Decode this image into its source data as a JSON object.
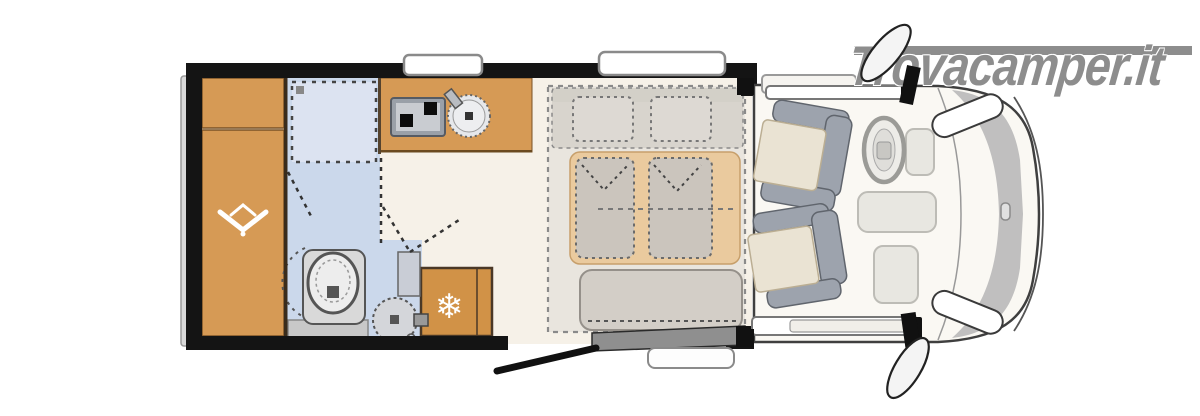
{
  "watermark": {
    "text": "Trovacamper.it",
    "color": "#8d8d8d"
  },
  "icons": {
    "snowflake": "❄",
    "hanger": "wardrobe-hanger-symbol"
  },
  "floorplan": {
    "type": "motorhome-top-view-layout",
    "vehicle_front": "right",
    "areas": [
      {
        "name": "rear-cabinet",
        "kind": "overhead cabinet",
        "color": "#d69a55"
      },
      {
        "name": "wardrobe",
        "kind": "wardrobe with hanger symbol",
        "color": "#d69a55"
      },
      {
        "name": "shower",
        "kind": "shower cubicle",
        "color": "#dce3f1"
      },
      {
        "name": "bathroom",
        "kind": "washroom with toilet and basin",
        "color": "#cbd8eb"
      },
      {
        "name": "kitchen",
        "kind": "kitchen block with 2-burner stove and round sink",
        "color": "#d69a55"
      },
      {
        "name": "refrigerator",
        "kind": "fridge with snowflake symbol",
        "color": "#d19247"
      },
      {
        "name": "bed",
        "kind": "double bed with two pillows and two duvets",
        "colors": [
          "#e9e5de",
          "#eaca9e",
          "#cbc5bd"
        ]
      },
      {
        "name": "bench-seat",
        "kind": "bench at foot of bed",
        "color": "#d3cec7"
      },
      {
        "name": "entry-door",
        "kind": "open entrance door with outside step"
      },
      {
        "name": "cab",
        "kind": "driver cab with two swivel captain seats, steering wheel, headlights, side mirrors",
        "color": "#faf8f3"
      }
    ],
    "fixtures": [
      "stove",
      "kitchen-sink",
      "toilet",
      "washbasin",
      "fridge",
      "roof-vent-rear",
      "roof-vent-middle",
      "cab-sunroof",
      "steering-wheel",
      "swivel-seat-top",
      "swivel-seat-bottom",
      "side-mirror-top",
      "side-mirror-bottom",
      "headlight-top",
      "headlight-bottom",
      "entry-step",
      "door-leaf"
    ],
    "colors": {
      "cabinet_wood": "#d69a55",
      "fridge_wood": "#d19247",
      "bath_floor": "#cbd8eb",
      "shower_tray": "#dce3f1",
      "living_floor": "#f6f1e8",
      "bed_platform": "#e9e5de",
      "mattress": "#eaca9e",
      "duvet": "#cbc5bd",
      "seat_frame": "#9da3ad",
      "seat_cushion": "#eae3d3",
      "wall": "#141414",
      "cab_body": "#faf8f3",
      "grille": "#b5b5b5",
      "watermark": "#8d8d8d"
    }
  }
}
